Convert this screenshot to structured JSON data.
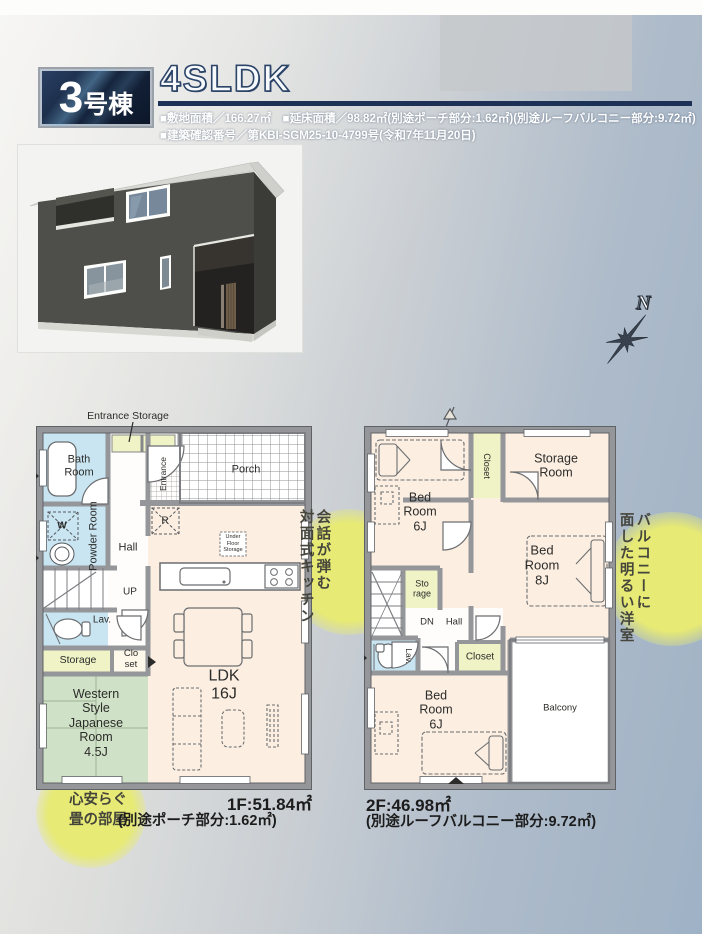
{
  "header": {
    "badge_number": "3",
    "badge_suffix": "号棟",
    "title": "4SLDK",
    "spec_line1": "■敷地面積／166.27㎡　■延床面積／98.82㎡(別途ポーチ部分:1.62㎡)(別途ルーフバルコニー部分:9.72㎡)",
    "spec_line2": "■建築確認番号／第KBI-SGM25-10-4799号(令和7年11月20日)"
  },
  "compass": {
    "north_label": "N"
  },
  "floor1": {
    "entrance_storage_label": "Entrance Storage",
    "rooms": {
      "bath": "Bath\nRoom",
      "powder": "Powder Room",
      "washer": "W",
      "hall": "Hall",
      "up": "UP",
      "entrance": "Entrance",
      "porch": "Porch",
      "fridge": "R",
      "under_floor": "Under\nFloor\nStorage",
      "lav": "Lav.",
      "storage": "Storage",
      "closet": "Clo\nset",
      "western": "Western\nStyle\nJapanese\nRoom\n4.5J",
      "ldk": "LDK\n16J"
    },
    "area_line1": "1F:51.84㎡",
    "area_line2": "(別途ポーチ部分:1.62㎡)"
  },
  "floor2": {
    "rooms": {
      "bed6_top": "Bed\nRoom\n6J",
      "closet_top": "Closet",
      "storage_room": "Storage\nRoom",
      "bed8": "Bed\nRoom\n8J",
      "storage_mid": "Sto\nrage",
      "dn": "DN",
      "hall": "Hall",
      "lav": "Lav.",
      "closet_mid": "Closet",
      "bed6_bottom": "Bed\nRoom\n6J",
      "balcony": "Balcony"
    },
    "area_line1": "2F:46.98㎡",
    "area_line2": "(別途ルーフバルコニー部分:9.72㎡)"
  },
  "callouts": {
    "kitchen": {
      "line1": "会話が弾む",
      "line2": "対面式キッチン"
    },
    "bright_room": {
      "line1": "バルコニーに",
      "line2": "面した明るい洋室"
    },
    "tatami": {
      "text": "心安らぐ\n畳の部屋"
    }
  },
  "colors": {
    "accent_navy": "#1d3156",
    "callout_yellow": "#e7ea74",
    "room_pink": "#fcefe2",
    "room_blue": "#c9e5f2",
    "room_green": "#cfe1c6",
    "room_yellow": "#eff3c6",
    "wall_gray": "#94969a",
    "background_bluegray": "#9fb2c5",
    "house_wall": "#4e4e4a"
  }
}
